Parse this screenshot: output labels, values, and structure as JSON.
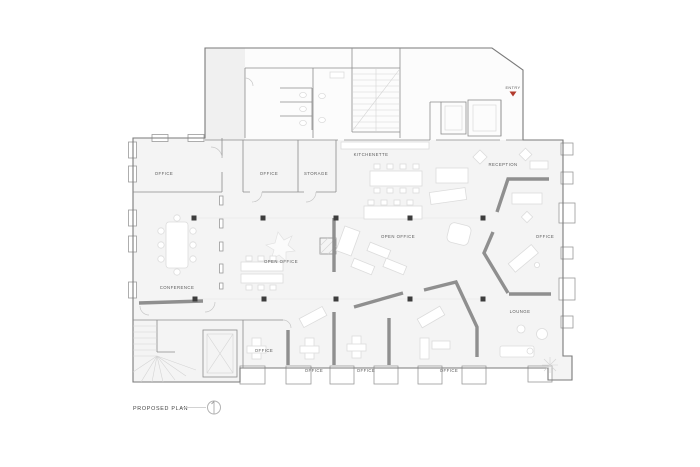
{
  "title_block": {
    "title": "PROPOSED PLAN"
  },
  "entry": {
    "label": "ENTRY"
  },
  "rooms": {
    "office_top_left": {
      "label": "OFFICE"
    },
    "office_small": {
      "label": "OFFICE"
    },
    "storage": {
      "label": "STORAGE"
    },
    "kitchenette": {
      "label": "KITCHENETTE"
    },
    "reception": {
      "label": "RECEPTION"
    },
    "conference": {
      "label": "CONFERENCE"
    },
    "open_office_west": {
      "label": "OPEN OFFICE"
    },
    "open_office_center": {
      "label": "OPEN OFFICE"
    },
    "office_east": {
      "label": "OFFICE"
    },
    "lounge": {
      "label": "LOUNGE"
    },
    "office_south_large": {
      "label": "OFFICE"
    },
    "office_south_1": {
      "label": "OFFICE"
    },
    "office_south_2": {
      "label": "OFFICE"
    },
    "office_south_3": {
      "label": "OFFICE"
    }
  },
  "colors": {
    "wall": "#7a7a7a",
    "partition": "#8f8f8f",
    "column": "#3d3d3d",
    "entry_marker": "#b23b2e",
    "floor_fill": "#f4f4f4",
    "label_text": "#555555"
  }
}
